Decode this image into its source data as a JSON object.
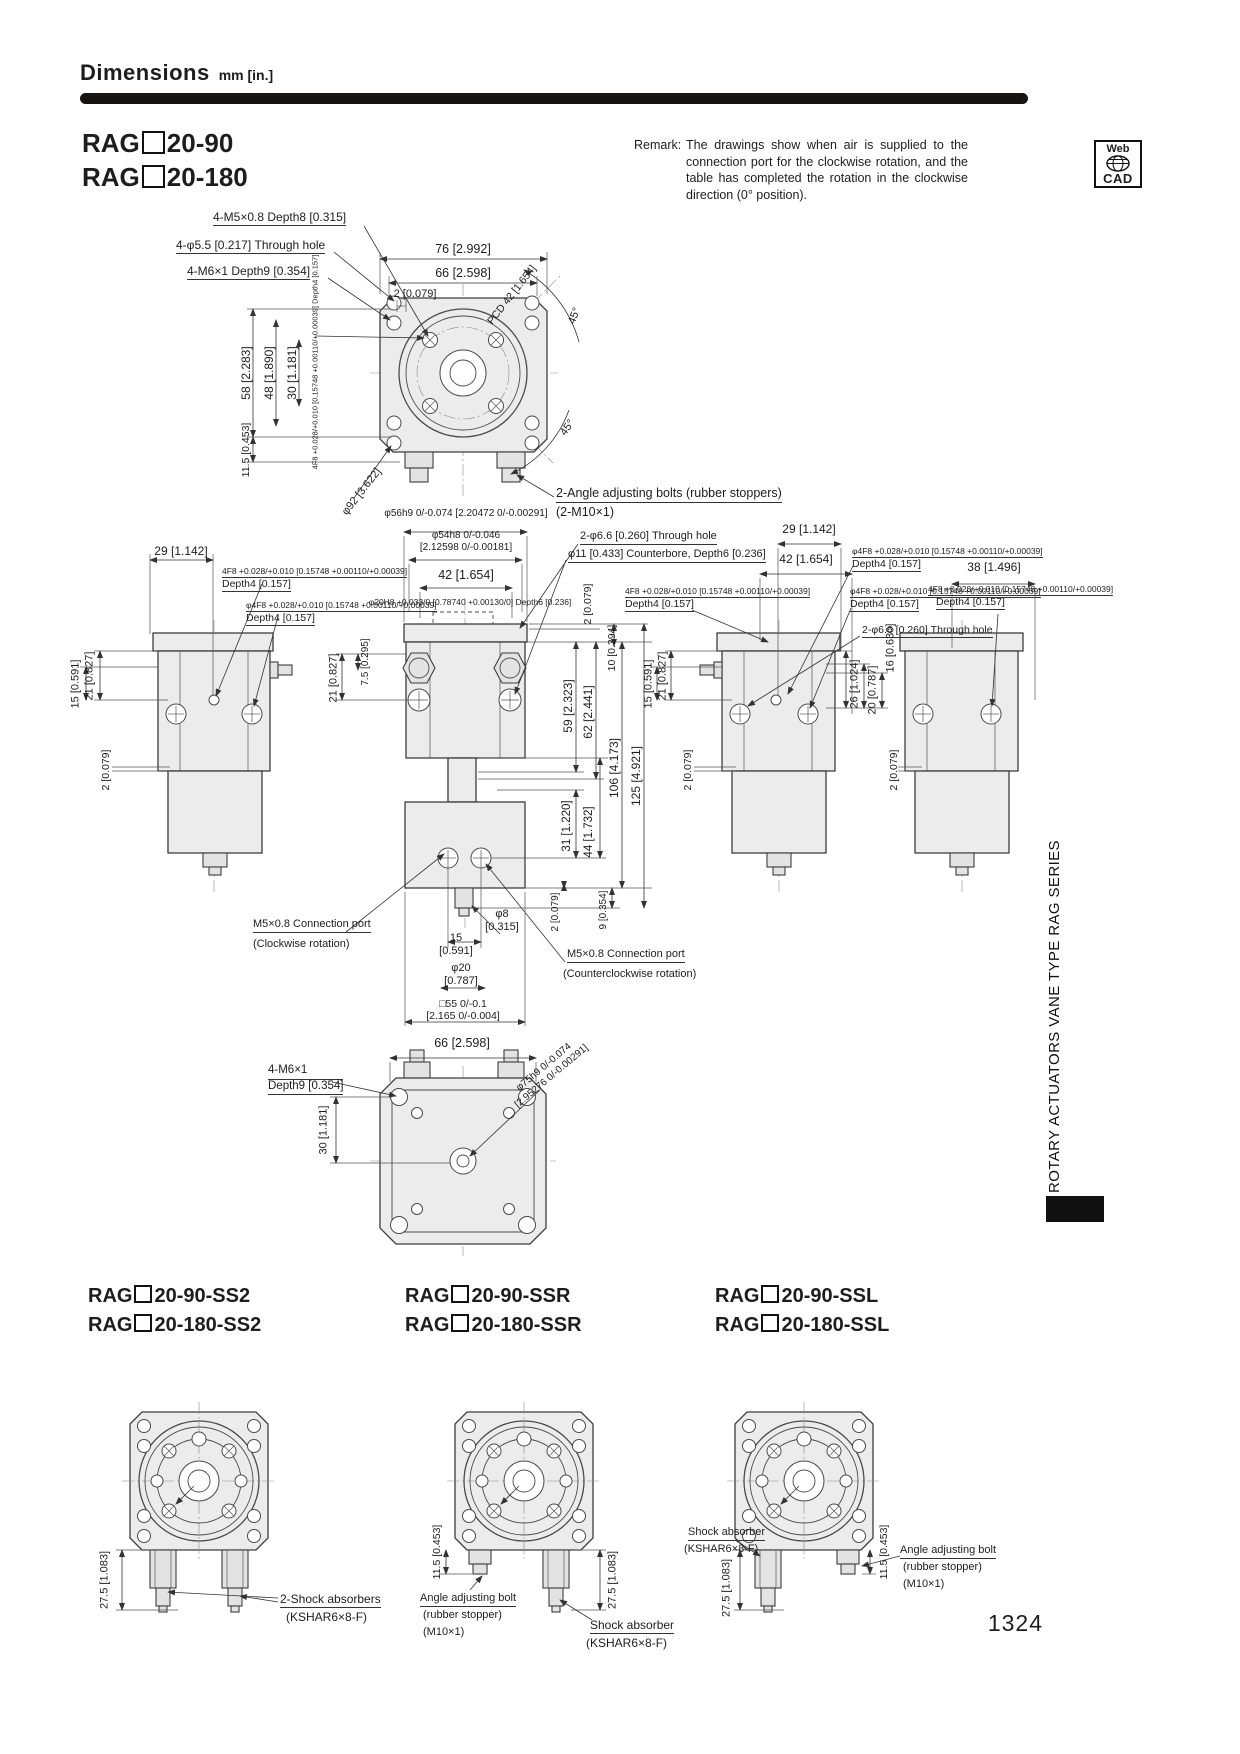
{
  "page": {
    "title": "Dimensions",
    "unit": "mm [in.]",
    "page_number": "1324",
    "sidebar_text": "ROTARY ACTUATORS VANE TYPE RAG SERIES",
    "webcad_top": "Web",
    "webcad_bottom": "CAD"
  },
  "remark": {
    "label": "Remark:",
    "text": "The drawings show when air is supplied to the connection port for the clockwise rotation, and the table has completed the rotation in the clockwise direction (0° position)."
  },
  "models": {
    "prefix": "RAG",
    "main": [
      "20-90",
      "20-180"
    ],
    "variants": [
      {
        "suffixes": [
          "20-90-SS2",
          "20-180-SS2"
        ]
      },
      {
        "suffixes": [
          "20-90-SSR",
          "20-180-SSR"
        ]
      },
      {
        "suffixes": [
          "20-90-SSL",
          "20-180-SSL"
        ]
      }
    ]
  },
  "annotations": [
    {
      "n": "label-4m5-depth8",
      "t": "4-M5×0.8 Depth8 [0.315]",
      "x": 213,
      "y": 210,
      "s": 12,
      "u": 1
    },
    {
      "n": "label-4phi55-through",
      "t": "4-φ5.5 [0.217] Through hole",
      "x": 176,
      "y": 238,
      "s": 12,
      "u": 1
    },
    {
      "n": "label-4m6-depth9",
      "t": "4-M6×1 Depth9 [0.354]",
      "x": 187,
      "y": 264,
      "s": 12,
      "u": 1
    },
    {
      "n": "dim-76",
      "t": "76 [2.992]",
      "x": 463,
      "y": 242,
      "s": 12.5,
      "c": 1
    },
    {
      "n": "dim-66-top",
      "t": "66 [2.598]",
      "x": 463,
      "y": 266,
      "s": 12.5,
      "c": 1
    },
    {
      "n": "dim-2-top",
      "t": "2 [0.079]",
      "x": 415,
      "y": 288,
      "s": 11,
      "c": 1
    },
    {
      "n": "dim-pcd42",
      "t": "PCD 42 [1.654]",
      "x": 512,
      "y": 295,
      "s": 10.5,
      "r": -52
    },
    {
      "n": "dim-45-upper",
      "t": "45°",
      "x": 575,
      "y": 316,
      "s": 11,
      "r": -68
    },
    {
      "n": "dim-45-lower",
      "t": "45°",
      "x": 568,
      "y": 428,
      "s": 11,
      "r": -55
    },
    {
      "n": "dim-58",
      "t": "58 [2.283]",
      "x": 246,
      "y": 373,
      "s": 12,
      "r": -90
    },
    {
      "n": "dim-48",
      "t": "48 [1.890]",
      "x": 269,
      "y": 373,
      "s": 12,
      "r": -90
    },
    {
      "n": "dim-30-top",
      "t": "30 [1.181]",
      "x": 292,
      "y": 373,
      "s": 12,
      "r": -90
    },
    {
      "n": "tol-4f8-topview",
      "t": "4F8 +0.028/+0.010 [0.15748 +0.00110/+0.00039] Depth4 [0.157]",
      "x": 316,
      "y": 362,
      "s": 7.5,
      "r": -90
    },
    {
      "n": "dim-115-top",
      "t": "11.5 [0.453]",
      "x": 246,
      "y": 450,
      "s": 10.5,
      "r": -90
    },
    {
      "n": "dim-phi92",
      "t": "φ92 [3.622]",
      "x": 362,
      "y": 492,
      "s": 11,
      "r": -52
    },
    {
      "n": "label-angle-bolts",
      "t": "2-Angle adjusting bolts (rubber stoppers)",
      "x": 556,
      "y": 486,
      "s": 12.5,
      "u": 1
    },
    {
      "n": "label-angle-bolts-2",
      "t": "(2-M10×1)",
      "x": 556,
      "y": 505,
      "s": 12.5
    },
    {
      "n": "dim-phi56h9",
      "t": "φ56h9 0/-0.074 [2.20472 0/-0.00291]",
      "x": 466,
      "y": 508,
      "s": 10,
      "c": 1
    },
    {
      "n": "dim-phi54h8",
      "l": [
        "φ54h8 0/-0.046",
        "[2.12598 0/-0.00181]"
      ],
      "x": 466,
      "y": 530,
      "s": 10,
      "c": 1
    },
    {
      "n": "dim-42-center",
      "t": "42 [1.654]",
      "x": 466,
      "y": 568,
      "s": 12.5,
      "c": 1
    },
    {
      "n": "tol-phi20h8",
      "t": "φ20H8 +0.033/0 [0.78740 +0.00130/0] Depth6 [0.236]",
      "x": 470,
      "y": 597,
      "s": 8.5,
      "c": 1
    },
    {
      "n": "dim-29-left",
      "t": "29 [1.142]",
      "x": 181,
      "y": 544,
      "s": 12,
      "c": 1
    },
    {
      "n": "tol-4f8-left1",
      "t": "4F8 +0.028/+0.010 [0.15748 +0.00110/+0.00039]",
      "x": 222,
      "y": 566,
      "s": 8.5,
      "u": 1
    },
    {
      "n": "tol-4f8-left1-depth",
      "t": "Depth4 [0.157]",
      "x": 222,
      "y": 578,
      "s": 10.5,
      "u": 1
    },
    {
      "n": "tol-phi4f8-left2",
      "t": "φ4F8 +0.028/+0.010 [0.15748 +0.00110/+0.00039]",
      "x": 246,
      "y": 600,
      "s": 8.5,
      "u": 1
    },
    {
      "n": "tol-phi4f8-left2-depth",
      "t": "Depth4 [0.157]",
      "x": 246,
      "y": 612,
      "s": 10.5,
      "u": 1
    },
    {
      "n": "dim-21-left",
      "t": "21 [0.827]",
      "x": 90,
      "y": 676,
      "s": 11,
      "r": -90
    },
    {
      "n": "dim-15-left",
      "t": "15 [0.591]",
      "x": 76,
      "y": 684,
      "s": 11,
      "r": -90
    },
    {
      "n": "dim-2-left",
      "t": "2 [0.079]",
      "x": 106,
      "y": 770,
      "s": 10.5,
      "r": -90
    },
    {
      "n": "dim-75-center",
      "t": "7.5 [0.295]",
      "x": 366,
      "y": 662,
      "s": 10,
      "r": -90
    },
    {
      "n": "dim-21-center",
      "t": "21 [0.827]",
      "x": 334,
      "y": 678,
      "s": 11,
      "r": -90
    },
    {
      "n": "label-2phi66-center",
      "t": "2-φ6.6 [0.260] Through hole",
      "x": 580,
      "y": 530,
      "s": 11,
      "u": 1
    },
    {
      "n": "label-phi11-counterbore",
      "t": "φ11 [0.433] Counterbore, Depth6 [0.236]",
      "x": 568,
      "y": 548,
      "s": 11,
      "u": 1
    },
    {
      "n": "dim-2-center-right",
      "t": "2 [0.079]",
      "x": 588,
      "y": 604,
      "s": 10.5,
      "r": -90
    },
    {
      "n": "dim-10",
      "t": "10 [0.394]",
      "x": 612,
      "y": 648,
      "s": 10.5,
      "r": -90
    },
    {
      "n": "dim-59",
      "t": "59 [2.323]",
      "x": 568,
      "y": 706,
      "s": 12,
      "r": -90
    },
    {
      "n": "dim-62",
      "t": "62 [2.441]",
      "x": 588,
      "y": 712,
      "s": 12,
      "r": -90
    },
    {
      "n": "dim-106",
      "t": "106 [4.173]",
      "x": 614,
      "y": 768,
      "s": 12,
      "r": -90
    },
    {
      "n": "dim-125",
      "t": "125 [4.921]",
      "x": 636,
      "y": 776,
      "s": 12,
      "r": -90
    },
    {
      "n": "dim-31",
      "t": "31 [1.220]",
      "x": 568,
      "y": 826,
      "s": 11.5,
      "r": -90
    },
    {
      "n": "dim-44",
      "t": "44 [1.732]",
      "x": 590,
      "y": 832,
      "s": 11.5,
      "r": -90
    },
    {
      "n": "dim-2-center-bottom",
      "t": "2 [0.079]",
      "x": 556,
      "y": 912,
      "s": 10,
      "r": -90
    },
    {
      "n": "dim-9",
      "t": "9 [0.354]",
      "x": 604,
      "y": 910,
      "s": 10,
      "r": -90
    },
    {
      "n": "dim-21-rmid",
      "t": "21 [0.827]",
      "x": 663,
      "y": 676,
      "s": 11,
      "r": -90
    },
    {
      "n": "dim-15-rmid",
      "t": "15 [0.591]",
      "x": 649,
      "y": 684,
      "s": 11,
      "r": -90
    },
    {
      "n": "dim-2-rmid",
      "t": "2 [0.079]",
      "x": 688,
      "y": 770,
      "s": 10.5,
      "r": -90
    },
    {
      "n": "dim-29-right",
      "t": "29 [1.142]",
      "x": 809,
      "y": 522,
      "s": 12,
      "c": 1
    },
    {
      "n": "dim-42-right",
      "t": "42 [1.654]",
      "x": 806,
      "y": 552,
      "s": 12,
      "c": 1
    },
    {
      "n": "tol-phi4f8-r1",
      "t": "φ4F8 +0.028/+0.010 [0.15748 +0.00110/+0.00039]",
      "x": 852,
      "y": 546,
      "s": 8.5,
      "u": 1
    },
    {
      "n": "tol-phi4f8-r1-depth",
      "t": "Depth4 [0.157]",
      "x": 852,
      "y": 558,
      "s": 10.5,
      "u": 1
    },
    {
      "n": "tol-phi4f8-r2",
      "t": "φ4F8 +0.028/+0.010 [0.15748 +0.00110/+0.00039]",
      "x": 850,
      "y": 586,
      "s": 8.5,
      "u": 1
    },
    {
      "n": "tol-phi4f8-r2-depth",
      "t": "Depth4 [0.157]",
      "x": 850,
      "y": 598,
      "s": 10.5,
      "u": 1
    },
    {
      "n": "label-2phi66-right",
      "t": "2-φ6.6 [0.260] Through hole",
      "x": 862,
      "y": 624,
      "s": 10.5,
      "u": 1
    },
    {
      "n": "tol-4f8-rmid",
      "t": "4F8 +0.028/+0.010 [0.15748 +0.00110/+0.00039]",
      "x": 625,
      "y": 586,
      "s": 8.5,
      "u": 1
    },
    {
      "n": "tol-4f8-rmid-depth",
      "t": "Depth4 [0.157]",
      "x": 625,
      "y": 598,
      "s": 10.5,
      "u": 1
    },
    {
      "n": "dim-26",
      "t": "26 [1.024]",
      "x": 855,
      "y": 684,
      "s": 11,
      "r": -90
    },
    {
      "n": "dim-20",
      "t": "20 [0.787]",
      "x": 873,
      "y": 690,
      "s": 11,
      "r": -90
    },
    {
      "n": "dim-16",
      "t": "16 [0.630]",
      "x": 891,
      "y": 648,
      "s": 11,
      "r": -90
    },
    {
      "n": "dim-38",
      "t": "38 [1.496]",
      "x": 994,
      "y": 560,
      "s": 12,
      "c": 1
    },
    {
      "n": "tol-4f8-farright",
      "t": "4F8 +0.028/+0.010 [0.15748 +0.00110/+0.00039]",
      "x": 928,
      "y": 584,
      "s": 8.5,
      "u": 1
    },
    {
      "n": "tol-4f8-farright-depth",
      "t": "Depth4 [0.157]",
      "x": 936,
      "y": 596,
      "s": 10.5,
      "u": 1
    },
    {
      "n": "dim-2-farright",
      "t": "2 [0.079]",
      "x": 894,
      "y": 770,
      "s": 10.5,
      "r": -90
    },
    {
      "n": "label-port-cw",
      "t": "M5×0.8 Connection port",
      "x": 253,
      "y": 918,
      "s": 11,
      "u": 1
    },
    {
      "n": "label-port-cw-2",
      "t": "(Clockwise rotation)",
      "x": 253,
      "y": 938,
      "s": 11
    },
    {
      "n": "dim-phi8",
      "l": [
        "φ8",
        "[0.315]"
      ],
      "x": 502,
      "y": 908,
      "s": 11,
      "c": 1
    },
    {
      "n": "dim-15-ports",
      "l": [
        "15",
        "[0.591]"
      ],
      "x": 456,
      "y": 932,
      "s": 11,
      "c": 1
    },
    {
      "n": "dim-phi20",
      "l": [
        "φ20",
        "[0.787]"
      ],
      "x": 461,
      "y": 962,
      "s": 11,
      "c": 1
    },
    {
      "n": "dim-sq55",
      "l": [
        "□55 0/-0.1",
        "[2.165 0/-0.004]"
      ],
      "x": 463,
      "y": 998,
      "s": 10.5,
      "c": 1
    },
    {
      "n": "label-port-ccw",
      "t": "M5×0.8 Connection port",
      "x": 567,
      "y": 948,
      "s": 11,
      "u": 1
    },
    {
      "n": "label-port-ccw-2",
      "t": "(Counterclockwise rotation)",
      "x": 563,
      "y": 968,
      "s": 11
    },
    {
      "n": "dim-66-bottomview",
      "t": "66 [2.598]",
      "x": 462,
      "y": 1036,
      "s": 12.5,
      "c": 1
    },
    {
      "n": "label-4m6-bottomview",
      "l": [
        "4-M6×1",
        "Depth9 [0.354]"
      ],
      "x": 268,
      "y": 1064,
      "s": 11.5,
      "u": 2
    },
    {
      "n": "dim-30-bottomview",
      "t": "30 [1.181]",
      "x": 324,
      "y": 1130,
      "s": 11,
      "r": -90
    },
    {
      "n": "dim-phi75h9",
      "l": [
        "φ75h9 0/-0.074",
        "[2.95276 0/-0.00291]"
      ],
      "x": 548,
      "y": 1072,
      "s": 10,
      "r": -40
    },
    {
      "n": "dim-275-ss2",
      "t": "27.5 [1.083]",
      "x": 105,
      "y": 1580,
      "s": 11,
      "r": -90
    },
    {
      "n": "label-shock-ss2",
      "t": "2-Shock absorbers",
      "x": 280,
      "y": 1592,
      "s": 12,
      "u": 1
    },
    {
      "n": "label-shock-ss2-type",
      "t": "(KSHAR6×8-F)",
      "x": 286,
      "y": 1610,
      "s": 12
    },
    {
      "n": "dim-115-ssr",
      "t": "11.5 [0.453]",
      "x": 437,
      "y": 1552,
      "s": 10.5,
      "r": -90
    },
    {
      "n": "label-anglebolt-ssr",
      "t": "Angle adjusting bolt",
      "x": 420,
      "y": 1592,
      "s": 11,
      "u": 1
    },
    {
      "n": "label-anglebolt-ssr-2",
      "t": "(rubber stopper)",
      "x": 423,
      "y": 1609,
      "s": 11
    },
    {
      "n": "label-anglebolt-ssr-3",
      "t": "(M10×1)",
      "x": 423,
      "y": 1626,
      "s": 11
    },
    {
      "n": "dim-275-ssr",
      "t": "27.5 [1.083]",
      "x": 613,
      "y": 1580,
      "s": 11,
      "r": -90
    },
    {
      "n": "label-shock-ssr",
      "t": "Shock absorber",
      "x": 590,
      "y": 1618,
      "s": 12,
      "u": 1
    },
    {
      "n": "label-shock-ssr-type",
      "t": "(KSHAR6×8-F)",
      "x": 586,
      "y": 1636,
      "s": 12
    },
    {
      "n": "dim-275-ssl",
      "t": "27.5 [1.083]",
      "x": 727,
      "y": 1588,
      "s": 11,
      "r": -90
    },
    {
      "n": "label-shock-ssl",
      "t": "Shock absorber",
      "x": 688,
      "y": 1526,
      "s": 11,
      "u": 1
    },
    {
      "n": "label-shock-ssl-type",
      "t": "(KSHAR6×8-F)",
      "x": 684,
      "y": 1543,
      "s": 11
    },
    {
      "n": "dim-115-ssl",
      "t": "11.5 [0.453]",
      "x": 884,
      "y": 1552,
      "s": 10.5,
      "r": -90
    },
    {
      "n": "label-anglebolt-ssl",
      "t": "Angle adjusting bolt",
      "x": 900,
      "y": 1544,
      "s": 11,
      "u": 1
    },
    {
      "n": "label-anglebolt-ssl-2",
      "t": "(rubber stopper)",
      "x": 903,
      "y": 1561,
      "s": 11
    },
    {
      "n": "label-anglebolt-ssl-3",
      "t": "(M10×1)",
      "x": 903,
      "y": 1578,
      "s": 11
    }
  ]
}
